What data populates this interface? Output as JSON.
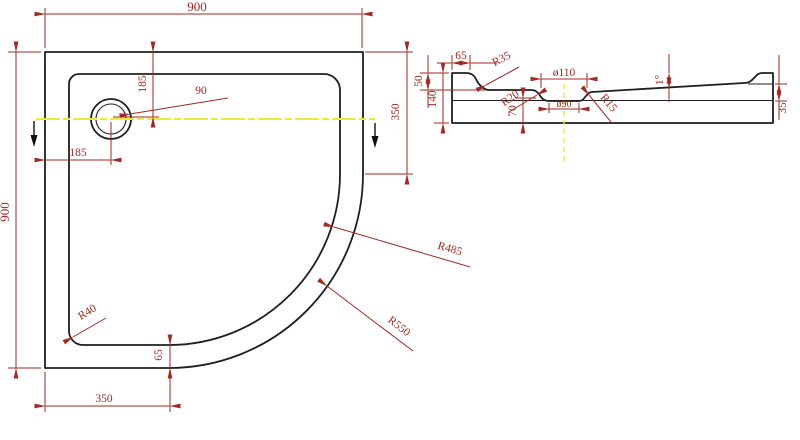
{
  "drawing": {
    "colors": {
      "dimension": "#a12a22",
      "outline": "#1f1f1f",
      "centerline": "#ece93f",
      "section_arrow": "#111111"
    },
    "top_view": {
      "width": "900",
      "height": "900",
      "drain_offset_from_top": "185",
      "drain_offset_from_left": "185",
      "drain_diameter": "90",
      "inner_corner_radius": "R40",
      "rim_width_at_bottom": "65",
      "straight_edge_bottom": "350",
      "straight_edge_right": "350",
      "inner_arc_radius": "R485",
      "outer_arc_radius": "R550"
    },
    "section_view": {
      "rim_flat_width": "65",
      "rim_corner_radius": "R35",
      "basin_depth": "50",
      "overall_height": "140",
      "waste_recess_radius": "R20",
      "waste_recess_depth": "70",
      "waste_top_diameter": "ø110",
      "waste_bottom_diameter": "ø90",
      "waste_edge_radius": "R15",
      "floor_slope_angle": "1°",
      "ledge_height": "35"
    }
  }
}
